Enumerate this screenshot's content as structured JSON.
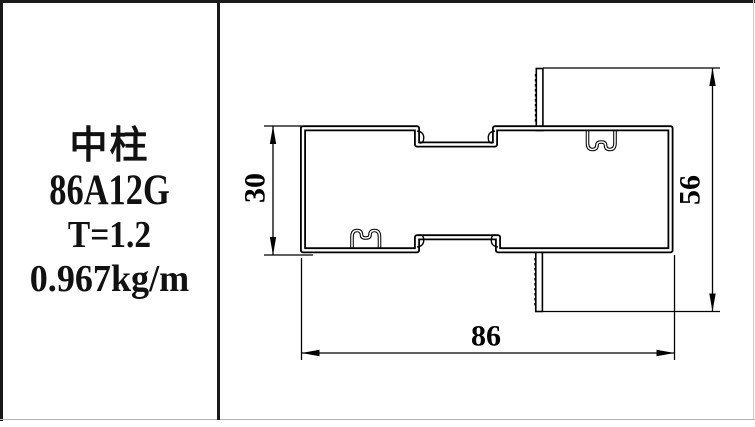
{
  "panel": {
    "name": "中柱",
    "model": "86A12G",
    "thickness": "T=1.2",
    "weight": "0.967kg/m"
  },
  "drawing": {
    "dim_30": "30",
    "dim_56": "56",
    "dim_86": "86",
    "line_color": "#000000",
    "background": "#ffffff"
  }
}
